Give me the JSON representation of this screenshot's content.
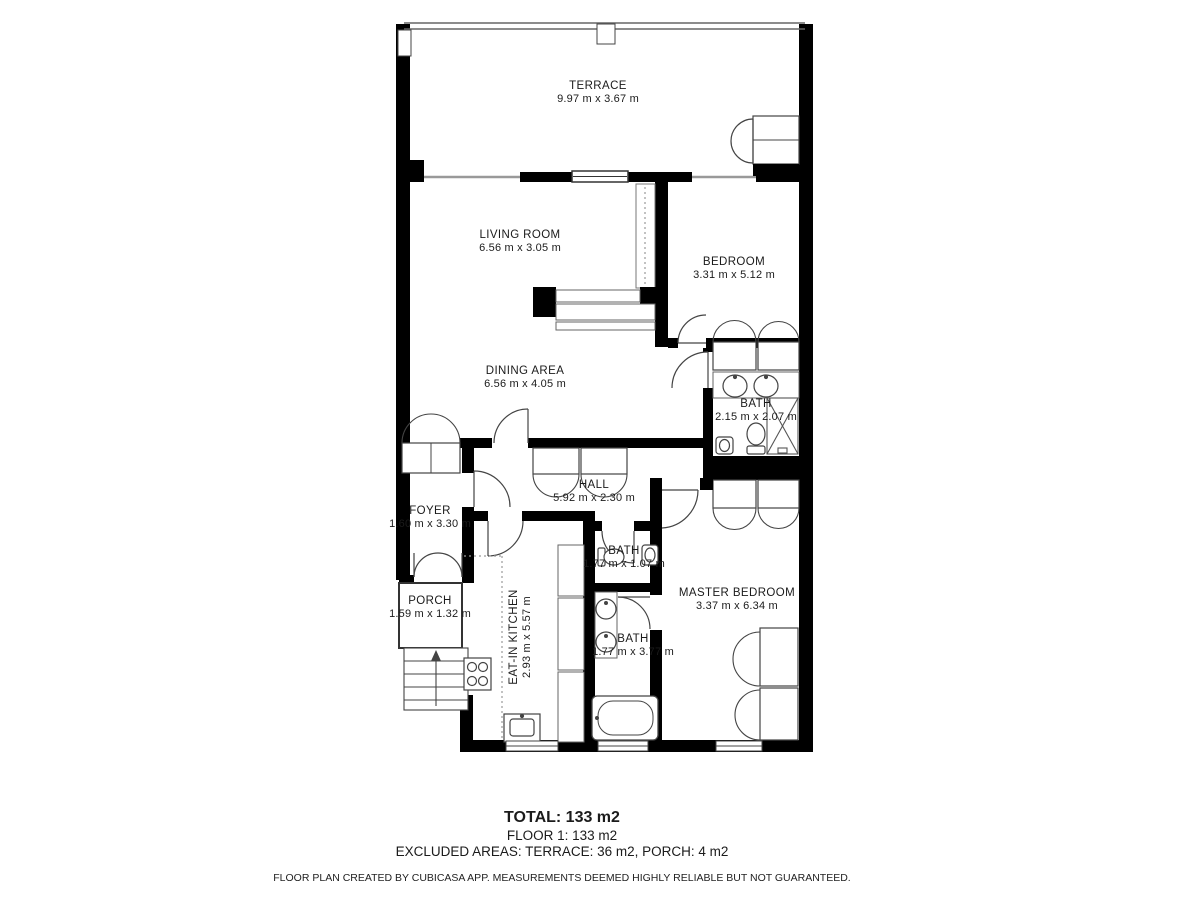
{
  "plan": {
    "rooms": [
      {
        "id": "terrace",
        "name": "TERRACE",
        "dims": "9.97 m x 3.67 m"
      },
      {
        "id": "living-room",
        "name": "LIVING ROOM",
        "dims": "6.56 m x 3.05 m"
      },
      {
        "id": "bedroom",
        "name": "BEDROOM",
        "dims": "3.31 m x 5.12 m"
      },
      {
        "id": "dining-area",
        "name": "DINING AREA",
        "dims": "6.56 m x 4.05 m"
      },
      {
        "id": "bath-upper",
        "name": "BATH",
        "dims": "2.15 m x 2.07 m"
      },
      {
        "id": "hall",
        "name": "HALL",
        "dims": "5.92 m x 2.30 m"
      },
      {
        "id": "foyer",
        "name": "FOYER",
        "dims": "1.60 m x 3.30 m"
      },
      {
        "id": "porch",
        "name": "PORCH",
        "dims": "1.59 m x 1.32 m"
      },
      {
        "id": "bath-small",
        "name": "BATH",
        "dims": "1.77 m x 1.07 m"
      },
      {
        "id": "eat-in-kitchen",
        "name": "EAT-IN KITCHEN",
        "dims": "2.93 m x 5.57 m"
      },
      {
        "id": "bath-master",
        "name": "BATH",
        "dims": "1.77 m x 3.77 m"
      },
      {
        "id": "master-bedroom",
        "name": "MASTER BEDROOM",
        "dims": "3.37 m x 6.34 m"
      }
    ]
  },
  "summary": {
    "total": "TOTAL: 133 m2",
    "floor": "FLOOR 1: 133 m2",
    "excluded": "EXCLUDED AREAS: TERRACE: 36 m2, PORCH: 4 m2",
    "disclaimer": "FLOOR PLAN CREATED BY CUBICASA APP. MEASUREMENTS DEEMED HIGHLY RELIABLE BUT NOT GUARANTEED."
  },
  "colors": {
    "wall": "#000000",
    "background": "#ffffff",
    "fixture_stroke": "#444444",
    "window_stroke": "#999999"
  }
}
